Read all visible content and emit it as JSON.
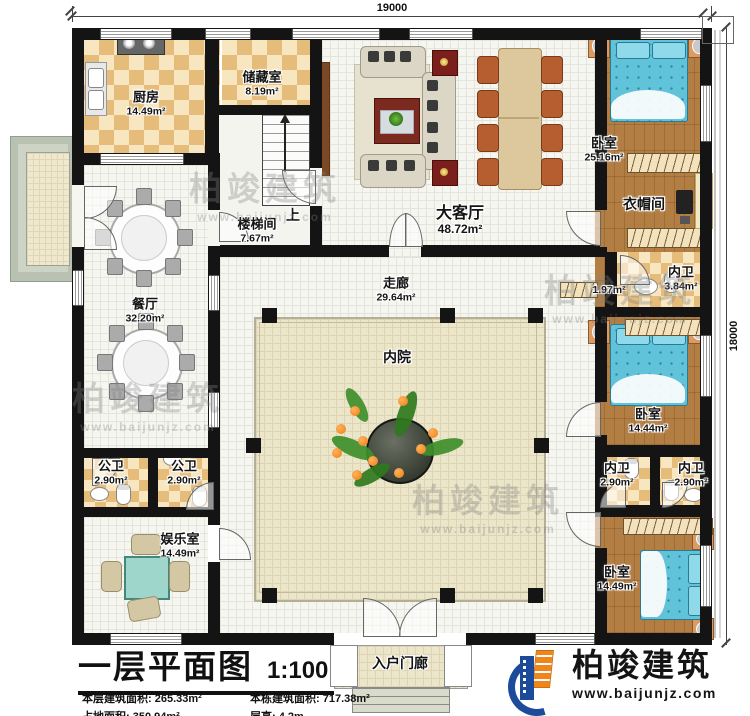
{
  "dimensions": {
    "top": "19000",
    "right": "18000"
  },
  "rooms": {
    "kitchen": {
      "name": "厨房",
      "area": "14.49m²"
    },
    "storage": {
      "name": "储藏室",
      "area": "8.19m²"
    },
    "stairwell": {
      "name": "楼梯间",
      "area": "7.67m²"
    },
    "stair_up": "上",
    "living": {
      "name": "大客厅",
      "area": "48.72m²"
    },
    "bedroom_top": {
      "name": "卧室",
      "area": "25.16m²"
    },
    "cloakroom": {
      "name": "衣帽间"
    },
    "hall": {
      "area": "1.97m²"
    },
    "bath_right_top": {
      "name": "内卫",
      "area": "3.84m²"
    },
    "corridor": {
      "name": "走廊",
      "area": "29.64m²"
    },
    "courtyard": {
      "name": "内院"
    },
    "dining": {
      "name": "餐厅",
      "area": "32.20m²"
    },
    "public_bath_left": {
      "name": "公卫",
      "area": "2.90m²"
    },
    "public_bath_right": {
      "name": "公卫",
      "area": "2.90m²"
    },
    "recreation": {
      "name": "娱乐室",
      "area": "14.49m²"
    },
    "bedroom_mid": {
      "name": "卧室",
      "area": "14.44m²"
    },
    "bath_bottom_left": {
      "name": "内卫",
      "area": "2.90m²"
    },
    "bath_bottom_right": {
      "name": "内卫",
      "area": "2.90m²"
    },
    "bedroom_bottom": {
      "name": "卧室",
      "area": "14.49m²"
    },
    "porch": {
      "name": "入户门廊"
    }
  },
  "titleblock": {
    "title": "一层平面图",
    "scale": "1:100",
    "stats": [
      {
        "label": "本层建筑面积:",
        "value": "265.33m²"
      },
      {
        "label": "本栋建筑面积:",
        "value": "717.38m²"
      },
      {
        "label": "占地面积:",
        "value": "350.94m²"
      },
      {
        "label": "层高:",
        "value": "4.2m"
      }
    ]
  },
  "brand": {
    "name": "柏竣建筑",
    "url": "www.baijunjz.com"
  },
  "watermark": {
    "name": "柏竣建筑",
    "url": "www.baijunjz.com"
  },
  "colors": {
    "wall": "#141414",
    "checker": "#e6bc7a",
    "wood": "#ab7439",
    "bed": "#60c3d9",
    "brand_blue": "#1c4b9c",
    "brand_orange": "#f08519"
  }
}
